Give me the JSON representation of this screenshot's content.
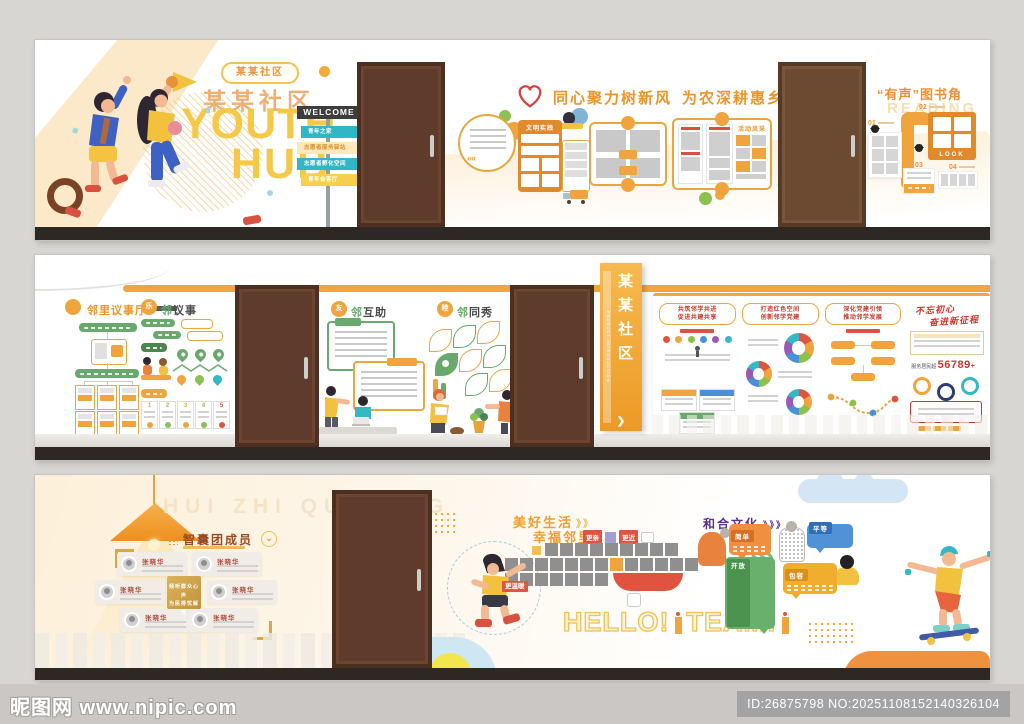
{
  "colors": {
    "orange": "#f09d3c",
    "yellow": "#f6c94d",
    "teal": "#35b8c6",
    "green": "#6aa96d",
    "red": "#e0543f",
    "blue": "#4a90d9",
    "purple": "#5b2e91",
    "brown_door": "#5e3b2b"
  },
  "panel1": {
    "badge": "某某社区",
    "title_cn": "某某社区",
    "title_en_line1": "YOUTH",
    "title_en_line2": "HUB",
    "signpost": {
      "header": "WELCOME",
      "arrows": [
        "青年之家",
        "志愿者服务驿站",
        "志愿者孵化空间",
        "青年会客厅"
      ]
    },
    "slogan_part1": "同心聚力树新风",
    "slogan_part2": "为农深耕惠乡邻",
    "board_civic_title": "文明实践",
    "board_activity_title": "活动风采",
    "reading": {
      "title": "“有声”图书角",
      "subtitle": "READING",
      "num1": "01",
      "num2": "02",
      "num3": "03",
      "num4": "04",
      "look": "LOOK"
    }
  },
  "panel2": {
    "section1": {
      "title": "邻里议事厅"
    },
    "section2": {
      "badge": "乐",
      "title": "邻议事"
    },
    "section3": {
      "badge": "友",
      "title": "邻互助"
    },
    "section4": {
      "badge": "睦",
      "title": "邻同秀"
    },
    "vertical_sign": {
      "title": "某某社区",
      "subtitle": "PRODUCT INTRODUCTION"
    },
    "board1": {
      "title_line1": "共筑邻学共进",
      "title_line2": "促进共建共享"
    },
    "board2": {
      "title_line1": "打造红色空间",
      "title_line2": "创新邻学党建"
    },
    "board3": {
      "title_line1": "深化党建引领",
      "title_line2": "推动邻学发展"
    },
    "board4": {
      "title_line1": "不忘初心",
      "title_line2": "奋进新征程",
      "stat_label": "服务居民超",
      "stat_value": "56789",
      "stat_suffix": "+"
    }
  },
  "panel3": {
    "bg_text": "HUI ZHI QU DONG",
    "team": {
      "title": "智囊团成员",
      "members": [
        {
          "name": "张晓华"
        },
        {
          "name": "张晓华"
        },
        {
          "name": "张晓华"
        },
        {
          "name": "张晓华"
        },
        {
          "name": "张晓华"
        },
        {
          "name": "张晓华"
        }
      ],
      "center_line1": "倾听群众心声",
      "center_line2": "为民排忧解难"
    },
    "slogan_line1": "美好生活",
    "slogan_line2": "幸福邻里",
    "tag1": "更亲",
    "tag2": "更近",
    "tag3": "更温暖",
    "hello_word1": "HELLO!",
    "hello_word2": "TEAM!",
    "culture": {
      "title": "和合文化",
      "bubble1": "简单",
      "bubble2": "平等",
      "bubble3": "开放",
      "bubble4": "包容"
    }
  },
  "watermark": {
    "site": "昵图网 www.nipic.com",
    "id_text": "ID:26875798 NO:20251108152140326104"
  }
}
